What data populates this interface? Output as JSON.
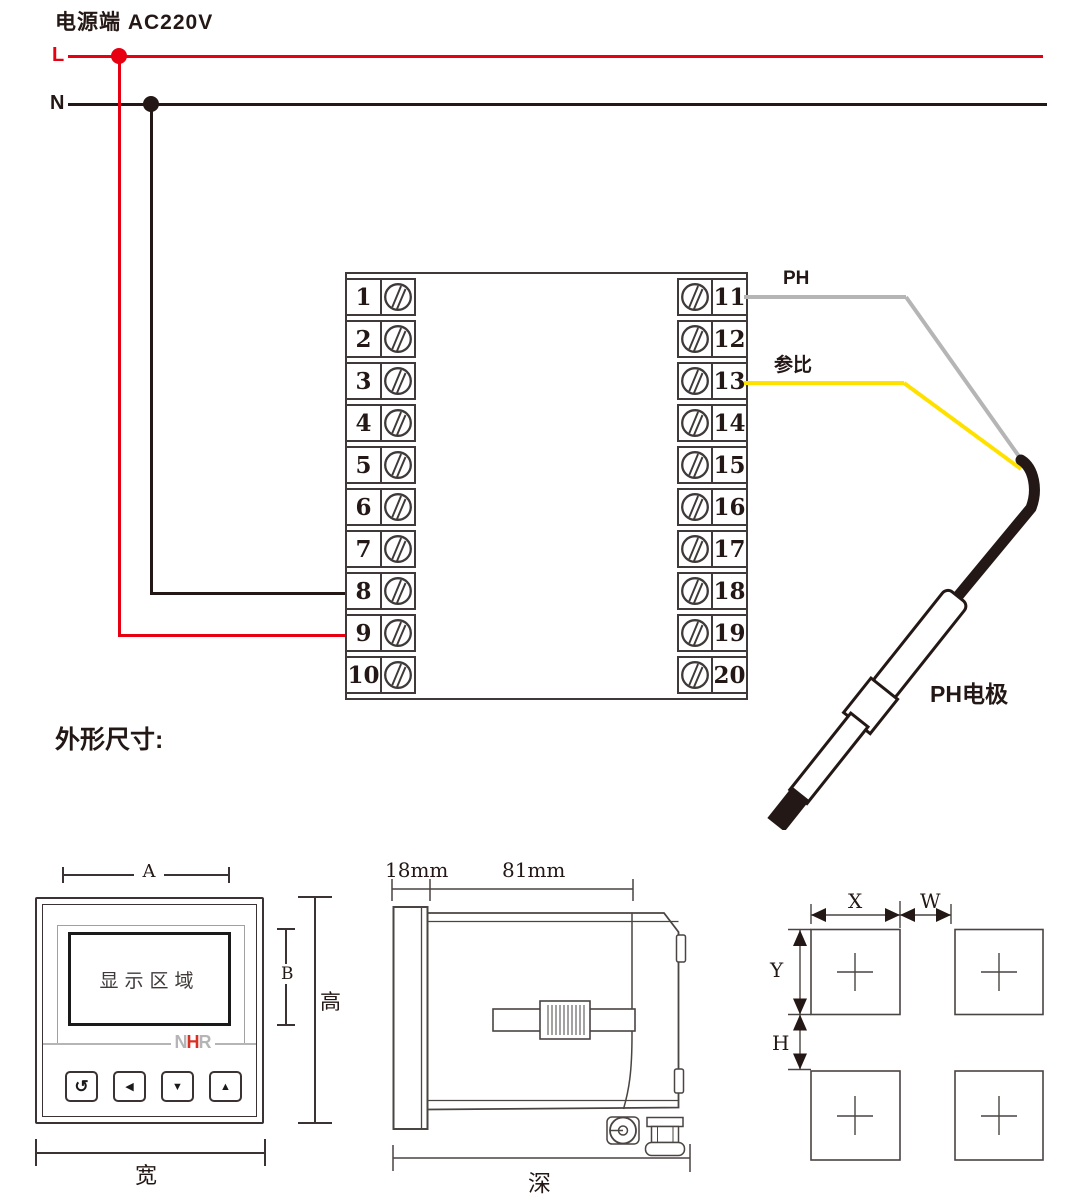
{
  "power": {
    "title": "电源端 AC220V",
    "l_label": "L",
    "n_label": "N"
  },
  "terminals": {
    "left": [
      "1",
      "2",
      "3",
      "4",
      "5",
      "6",
      "7",
      "8",
      "9",
      "10"
    ],
    "right": [
      "11",
      "12",
      "13",
      "14",
      "15",
      "16",
      "17",
      "18",
      "19",
      "20"
    ]
  },
  "probe": {
    "ph_label": "PH",
    "ref_label": "参比",
    "electrode_label": "PH电极"
  },
  "dimensions": {
    "section_title": "外形尺寸:",
    "front": {
      "dim_a": "A",
      "dim_b": "B",
      "height_label": "高",
      "width_label": "宽",
      "display_label": "显示区域",
      "logo_n": "N",
      "logo_h": "H",
      "logo_r": "R",
      "btn_back": "↺",
      "btn_left": "◀",
      "btn_down": "▼",
      "btn_up": "▲"
    },
    "side": {
      "dim_front": "18mm",
      "dim_body": "81mm",
      "depth_label": "深"
    },
    "cutout": {
      "dim_x": "X",
      "dim_w": "W",
      "dim_y": "Y",
      "dim_h": "H"
    }
  },
  "colors": {
    "live_wire": "#e60012",
    "neutral_wire": "#231815",
    "ph_wire": "#b5b5b6",
    "ref_wire": "#ffe100",
    "logo_red": "#d93026",
    "logo_gray": "#b5b5b6",
    "drawing_stroke": "#4a4442"
  }
}
